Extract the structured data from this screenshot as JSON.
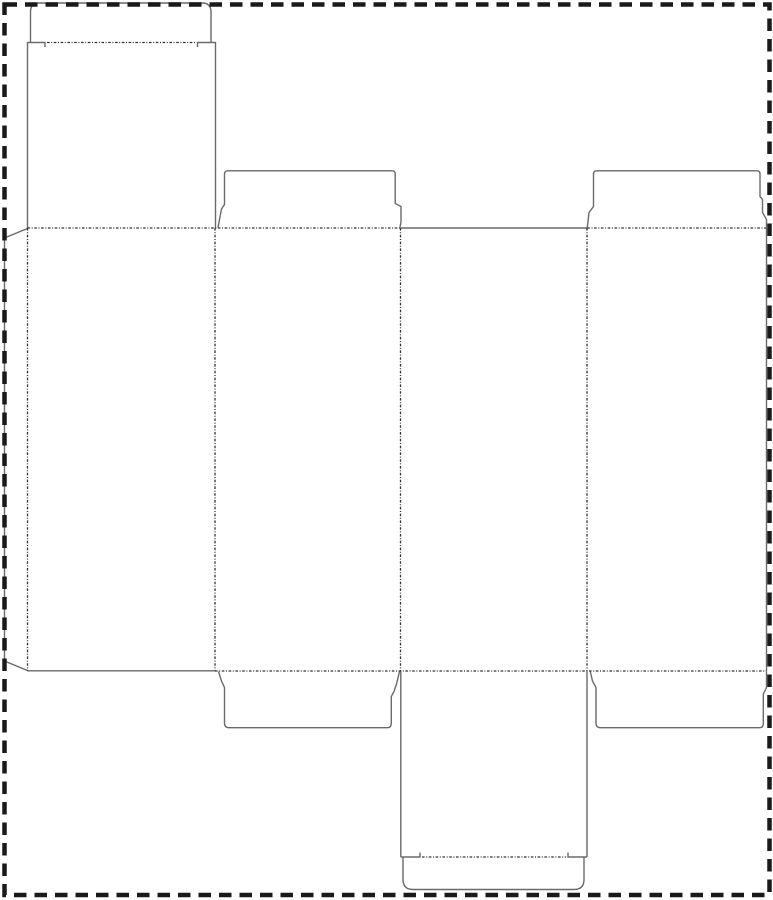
{
  "page": {
    "width": 773,
    "height": 900,
    "background_color": "#ffffff",
    "description": "blank box dieline template, no text content"
  },
  "dieline": {
    "colors": {
      "cut_line": "#6a6a6a",
      "fold_line": "#333333",
      "page_border": "#1a1a1a"
    },
    "stroke": {
      "cut_width": 1.4,
      "fold_width": 1.3,
      "border_width": 4.5,
      "fold_dash": "2.6 1.6 1 1.6",
      "border_dash": "12.5 8"
    },
    "border_rect": {
      "x": 4.5,
      "y": 4.5,
      "w": 765,
      "h": 890.5
    },
    "cut_paths": [
      {
        "name": "top-tuck-flap-outline",
        "d": "M 30.5 42.5 L 30.5 12 Q 30.5 3 39.5 3 L 202 3 Q 211 3 211 12 L 211 42.5"
      },
      {
        "name": "top-tuck-slit-left",
        "d": "M 27.5 42.5 L 45 42.5 L 45 47"
      },
      {
        "name": "top-tuck-slit-right",
        "d": "M 215.5 42.5 L 197.5 42.5 L 197.5 47"
      },
      {
        "name": "top-lid-left-edge",
        "d": "M 27.5 42 L 27.5 228"
      },
      {
        "name": "top-lid-right-edge",
        "d": "M 215.5 42 L 215.5 228"
      },
      {
        "name": "top-dust-flap-panel2",
        "d": "M 218 227.5 L 221.5 209 L 224.5 204.5 L 224.5 174 Q 224.5 170.8 227.8 170.8 L 392 170.8 Q 395.2 170.8 395.2 174 L 395.2 203.5 L 401 206.5 L 401 221.5 L 400 227.5"
      },
      {
        "name": "top-dust-flap-panel4",
        "d": "M 587.3 227.5 L 589 212.5 L 593.5 206.5 L 593.5 174 Q 593.5 170.8 596.8 170.8 L 757 170.8 Q 760 170.8 760 174 L 760 196.5 L 762.5 199.5 L 762.5 212.5 L 766.5 219.5 L 766.5 227.5"
      },
      {
        "name": "panel3-top-cut-edge",
        "d": "M 400.5 228 L 587 228"
      },
      {
        "name": "panel4-right-cut-edge",
        "d": "M 766.5 228 L 766.5 671"
      },
      {
        "name": "panel1-bottom-cut-edge",
        "d": "M 27.5 670.8 L 215 670.8"
      },
      {
        "name": "glue-flap-outline",
        "d": "M 27.5 228.5 L 4.5 238 L 4.5 661 L 27.5 670.5"
      },
      {
        "name": "bottom-dust-flap-panel2",
        "d": "M 218.5 671.5 L 221.5 681 L 224.5 687.5 L 224.5 723 Q 224.5 727.7 229 727.7 L 387.5 727.7 Q 391.3 727.7 391.3 723.5 L 391.3 696.5 L 394 691.5 L 396.5 684 L 399.5 671.5"
      },
      {
        "name": "bottom-dust-flap-panel4",
        "d": "M 590.3 671.5 L 592.5 681 L 596 687.5 L 596 723 Q 596 727.7 600.5 727.7 L 759.5 727.7 Q 763.3 727.7 763.3 723.5 L 763.3 694 L 766.5 687.5 L 766.5 671.5"
      },
      {
        "name": "bottom-lid-left-edge",
        "d": "M 400.8 671.5 L 400.8 857"
      },
      {
        "name": "bottom-lid-right-edge",
        "d": "M 587 671.5 L 587 857"
      },
      {
        "name": "bottom-tuck-slit-left",
        "d": "M 400.8 857 L 420 857 L 420 852.5"
      },
      {
        "name": "bottom-tuck-slit-right",
        "d": "M 587 857 L 568 857 L 568 852.5"
      },
      {
        "name": "bottom-tuck-flap-outline",
        "d": "M 403 857 L 403 879.5 Q 403 889.5 413 889.5 L 574 889.5 Q 584 889.5 584 879.5 L 584 857"
      }
    ],
    "fold_paths": [
      {
        "name": "top-tuck-fold",
        "d": "M 47 42.5 L 195.5 42.5"
      },
      {
        "name": "top-fold-left-section",
        "d": "M 27.5 228 L 400 228"
      },
      {
        "name": "top-fold-right-section",
        "d": "M 587.3 228 L 766.5 228"
      },
      {
        "name": "glue-flap-fold",
        "d": "M 27.5 228 L 27.5 671"
      },
      {
        "name": "fold-panel1-panel2",
        "d": "M 215 228 L 215 671"
      },
      {
        "name": "fold-panel2-panel3",
        "d": "M 400.5 228 L 400.5 671"
      },
      {
        "name": "fold-panel3-panel4",
        "d": "M 587 228 L 587 671"
      },
      {
        "name": "bottom-fold",
        "d": "M 215 671 L 766.5 671"
      },
      {
        "name": "bottom-tuck-fold",
        "d": "M 422 857 L 566 857"
      }
    ]
  }
}
